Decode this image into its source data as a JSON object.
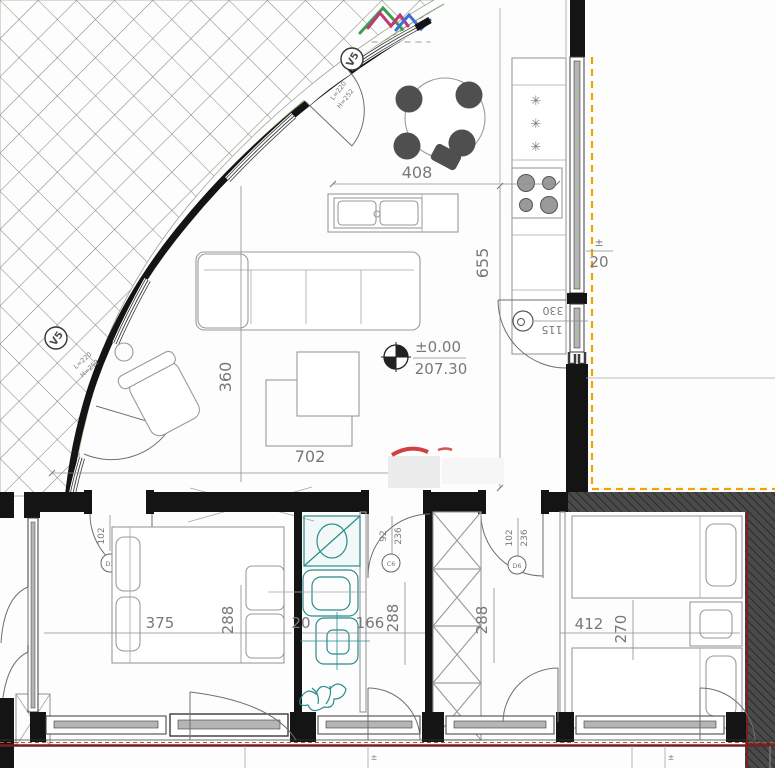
{
  "labels": {
    "dims": {
      "a408": "408",
      "a655": "655",
      "a360": "360",
      "a702": "702",
      "a375": "375",
      "a288_1": "288",
      "a20_1": "20",
      "a166": "166",
      "a288_2": "288",
      "a288_3": "288",
      "a412": "412",
      "a270": "270",
      "a20_right": "20",
      "pm_right": "±"
    },
    "level": {
      "top": "±0.00",
      "bottom": "207.30"
    },
    "opening": {
      "w": "330",
      "h": "115"
    },
    "vents": [
      {
        "id": "V5",
        "note1": "L=220",
        "note2": "H=252"
      },
      {
        "id": "V5",
        "note1": "L=220",
        "note2": "H=252"
      }
    ],
    "freezer_stars": [
      "✳",
      "✳",
      "✳"
    ],
    "door_tags": [
      {
        "w": "102",
        "h": "205",
        "mark": "D3"
      },
      {
        "w": "92",
        "h": "236",
        "mark": "C6"
      },
      {
        "w": "102",
        "h": "236",
        "mark": "D6"
      }
    ],
    "survey_marks": [
      "±",
      "±"
    ]
  },
  "colors": {
    "teal": "#2a8c8c",
    "orange": "#f0a400",
    "maroon": "#7a1f1f",
    "red_mark": "#cc2b2b",
    "hatch": "#7c8876",
    "green_rail": "#6d9b54",
    "wall": "#141414",
    "dark_band": "#3d3d3d",
    "logo_pink": "#c2377b",
    "logo_green": "#3a9e4b",
    "logo_blue": "#3b6fd6"
  }
}
